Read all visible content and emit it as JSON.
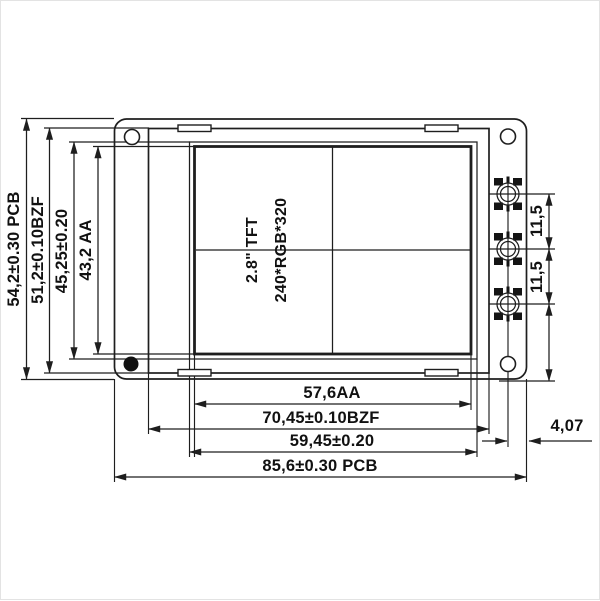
{
  "display": {
    "size_label": "2.8\" TFT",
    "resolution_label": "240*RGB*320"
  },
  "dimensions": {
    "left": [
      {
        "label": "54,2±0.30 PCB"
      },
      {
        "label": "51,2±0.10BZF"
      },
      {
        "label": "45,25±0.20"
      },
      {
        "label": "43,2 AA"
      }
    ],
    "bottom": [
      {
        "label": "57,6AA"
      },
      {
        "label": "70,45±0.10BZF"
      },
      {
        "label": "59,45±0.20"
      },
      {
        "label": "85,6±0.30 PCB"
      }
    ],
    "right": [
      {
        "label": "11,5"
      },
      {
        "label": "11,5"
      },
      {
        "label": "4,07"
      }
    ]
  },
  "colors": {
    "line": "#1e1e1e",
    "text": "#111111",
    "background": "#ffffff"
  }
}
